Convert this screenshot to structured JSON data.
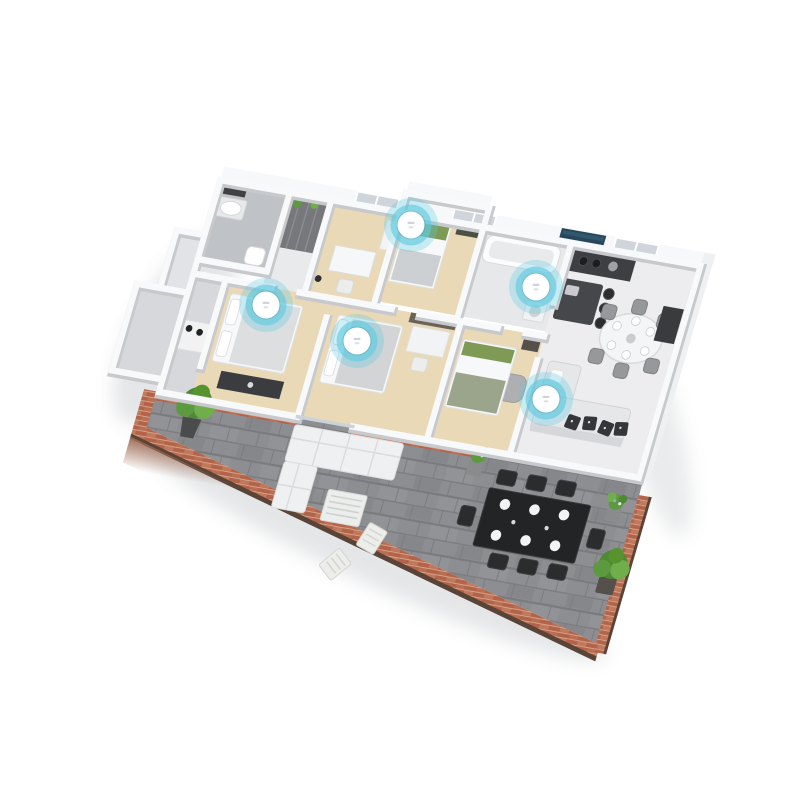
{
  "meta": {
    "title": "3D isometric apartment floor plan with smart-home sensor hotspots",
    "canvas_width": 800,
    "canvas_height": 800,
    "background": "#ffffff"
  },
  "sensors": {
    "count": 5,
    "style": {
      "halo_color": "#5ec9e0",
      "ring_color": "#5ec9e0",
      "disc_color": "#ffffff",
      "glyph_color": "#c2c9ce",
      "halo_radius": 27,
      "ring_radius": 20.5,
      "disc_radius": 13.5
    },
    "items": [
      {
        "id": "sensor-1",
        "room": "bedroom-left",
        "cx": 266,
        "cy": 305
      },
      {
        "id": "sensor-2",
        "room": "bedroom-top",
        "cx": 411,
        "cy": 225
      },
      {
        "id": "sensor-3",
        "room": "bedroom-middle",
        "cx": 357,
        "cy": 341
      },
      {
        "id": "sensor-4",
        "room": "kitchen",
        "cx": 536,
        "cy": 287
      },
      {
        "id": "sensor-5",
        "room": "living-room",
        "cx": 546,
        "cy": 399
      }
    ]
  },
  "floor_plan": {
    "rooms": [
      {
        "id": "bathroom-1",
        "floor": "gray-tile"
      },
      {
        "id": "walk-in-closet",
        "floor": "white"
      },
      {
        "id": "bedroom-desk",
        "floor": "beige-wood"
      },
      {
        "id": "bedroom-top",
        "floor": "beige-wood"
      },
      {
        "id": "bathroom-2",
        "floor": "light-gray"
      },
      {
        "id": "kitchen",
        "floor": "light-gray"
      },
      {
        "id": "dining-area",
        "floor": "light-gray"
      },
      {
        "id": "living-room",
        "floor": "light-gray"
      },
      {
        "id": "bedroom-left",
        "floor": "beige-wood"
      },
      {
        "id": "bedroom-middle",
        "floor": "beige-wood"
      },
      {
        "id": "bedroom-small",
        "floor": "beige-wood"
      },
      {
        "id": "entry-hall",
        "floor": "gray"
      },
      {
        "id": "terrace",
        "floor": "gray-stone-tiles"
      }
    ],
    "windows": {
      "back_wall_pairs": 3
    },
    "furniture": [
      "vanity-sink-with-mirror",
      "toilet",
      "wardrobe-cabinets",
      "desk-with-chair",
      "single-bed-green-pillows",
      "bathtub",
      "washer",
      "kitchen-wall-counter-with-cooktop",
      "kitchen-island",
      "bar-stools-x3",
      "wall-art-panel",
      "oval-dining-table",
      "dining-chairs-x6",
      "corner-sofa-with-patterned-pillows",
      "armchair",
      "media-console",
      "double-bed-left",
      "double-bed-middle",
      "bedroom-bench",
      "outdoor-l-shaped-sofa",
      "slatted-coffee-table",
      "folding-chairs-x2",
      "outdoor-dining-table-black",
      "outdoor-chairs-x8",
      "table-settings-white-plates"
    ],
    "plants": [
      {
        "id": "terrace-tree-left",
        "type": "tree-in-pot"
      },
      {
        "id": "flower-pot-by-door",
        "type": "flowering-plant"
      },
      {
        "id": "flower-pot-right-edge",
        "type": "flowering-plant"
      },
      {
        "id": "bush-bottom-right",
        "type": "bush-in-pot"
      },
      {
        "id": "closet-plants",
        "type": "small-green-plants"
      }
    ],
    "features": [
      "brick-parapet-walls",
      "sliding-glass-door",
      "stone-tiled-terrace"
    ]
  },
  "palette": {
    "background": "#ffffff",
    "wall_white": "#f8f9fa",
    "wall_shadow": "#c7c9cc",
    "floor_light": "#ededef",
    "floor_beige": "#ead9b6",
    "floor_bath": "#bfc3c7",
    "floor_entry": "#d6d8db",
    "terrace_tile": "#8d8e91",
    "terrace_joint": "#7a7b7e",
    "brick": "#b2634a",
    "brick_light": "#c1795c",
    "brick_cap": "#5a4337",
    "furniture_dark": "#3e3f42",
    "table_black": "#232426",
    "sofa_gray": "#e6e7e9",
    "art_panel_blue": "#27475c",
    "plant_green": "#4e8a34",
    "sensor_blue": "#5ec9e0"
  }
}
